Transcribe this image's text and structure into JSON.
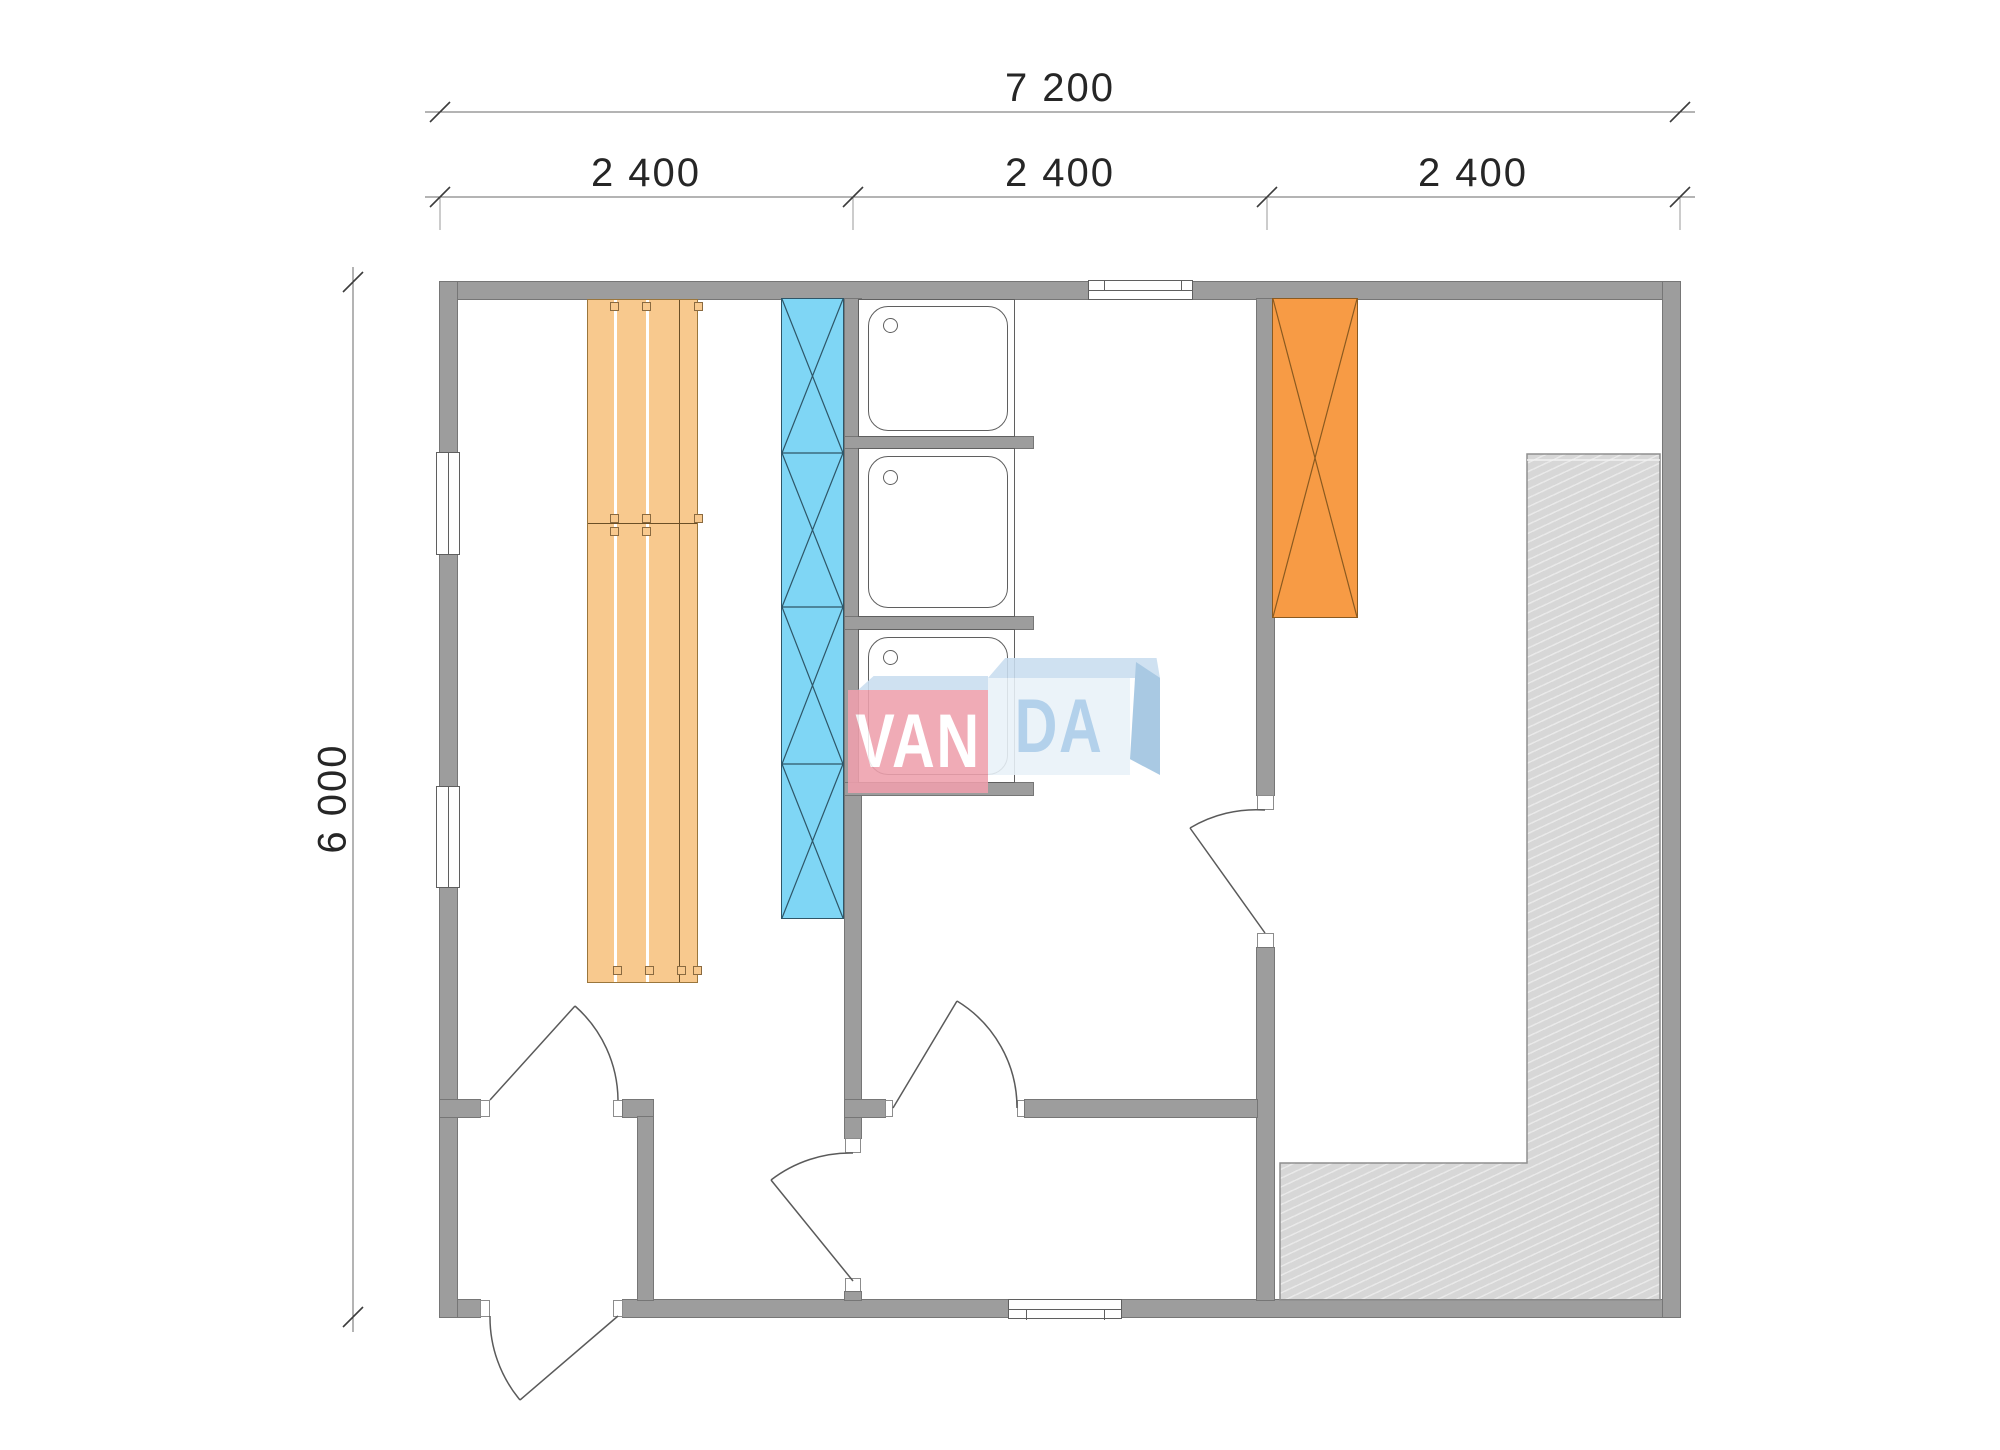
{
  "dimensions": {
    "top_total": "7 200",
    "top_segments": [
      "2 400",
      "2 400",
      "2 400"
    ],
    "left_total": "6 000"
  },
  "watermark": {
    "full": "VANDA",
    "left_text": "VAN",
    "right_text": "DA"
  },
  "palette": {
    "wall": "#9d9d9d",
    "wall_edge": "#767676",
    "bench": "#f8c98e",
    "bench_edge": "#9a763c",
    "heater": "#7fd6f5",
    "heater_line": "#2e5668",
    "wardrobe": "#f79b45",
    "wardrobe_line": "#8a5a20",
    "deck_fill": "#dadada",
    "deck_edge": "#8f8f8f",
    "fixture_line": "#5f5f5f",
    "dimension_text": "#262626",
    "logo_pink": "#efa0ad",
    "logo_red_side": "#bf5260",
    "logo_blue_top": "#c9def0",
    "logo_blue_face": "#e9f2f9",
    "logo_blue_text": "#a9cbe9",
    "logo_blue_side": "#9ec2e0"
  },
  "elements": {
    "benches": "sauna-bench-planks",
    "heater": "heater-hatched-strip",
    "showers": [
      "shower-stall-1",
      "shower-stall-2",
      "shower-stall-3"
    ],
    "wardrobe": "wardrobe-cross-box",
    "deck": "l-shaped-hatched-deck",
    "doors": [
      "vestibule-interior-door",
      "exterior-entrance-door",
      "shower-room-door",
      "sauna-strip-door",
      "rest-room-door"
    ],
    "windows": [
      "left-upper-window",
      "left-lower-window",
      "top-window",
      "bottom-window"
    ]
  }
}
